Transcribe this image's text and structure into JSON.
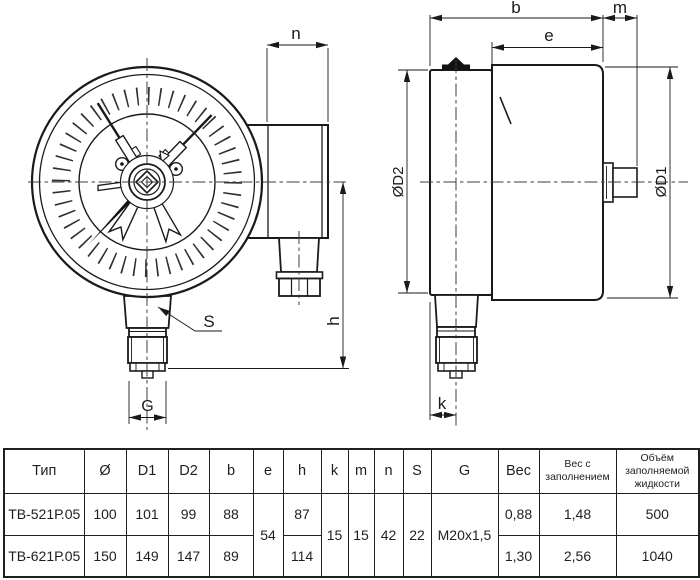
{
  "drawing": {
    "front_view": {
      "dim_n": "n",
      "dim_s": "S",
      "dim_g": "G",
      "dim_h": "h"
    },
    "side_view": {
      "dim_b": "b",
      "dim_e": "e",
      "dim_m": "m",
      "dim_d2": "ØD2",
      "dim_d1": "ØD1",
      "dim_k": "k"
    }
  },
  "table": {
    "headers": [
      "Тип",
      "Ø",
      "D1",
      "D2",
      "b",
      "e",
      "h",
      "k",
      "m",
      "n",
      "S",
      "G",
      "Вес",
      "Вес с заполнением",
      "Объём заполняемой жидкости"
    ],
    "rows": [
      {
        "type": "ТВ-521Р.05",
        "d": "100",
        "d1": "101",
        "d2": "99",
        "b": "88",
        "h": "87",
        "ves": "0,88",
        "ves_full": "1,48",
        "volume": "500"
      },
      {
        "type": "ТВ-621Р.05",
        "d": "150",
        "d1": "149",
        "d2": "147",
        "b": "89",
        "h": "114",
        "ves": "1,30",
        "ves_full": "2,56",
        "volume": "1040"
      }
    ],
    "shared": {
      "e": "54",
      "k": "15",
      "m": "15",
      "n": "42",
      "s": "22",
      "g": "M20x1,5"
    }
  }
}
